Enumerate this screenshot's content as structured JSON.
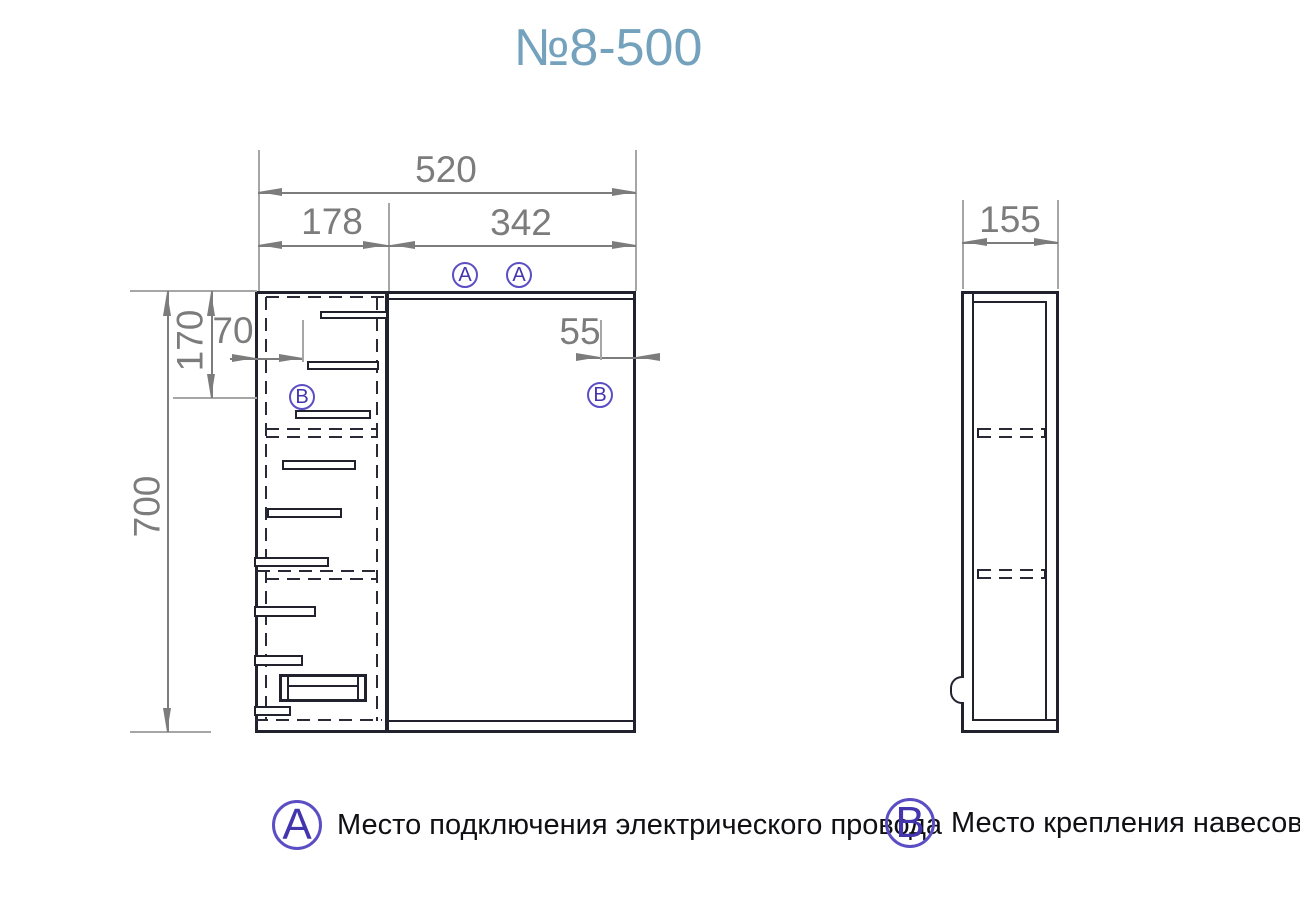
{
  "title": "№8-500",
  "markers": {
    "a": "А",
    "b": "В"
  },
  "front_view": {
    "dims": {
      "total_width": "520",
      "left_section_width": "178",
      "door_width": "342",
      "hinge_offset_left": "70",
      "hinge_offset_top": "170",
      "height": "700",
      "hinge_offset_right": "55"
    }
  },
  "side_view": {
    "depth": "155"
  },
  "legend": [
    {
      "symbol": "А",
      "text": "Место подключения электрического провода"
    },
    {
      "symbol": "В",
      "text": "Место крепления навесов"
    }
  ],
  "colors": {
    "line": "#22222e",
    "dimension": "#7c7c7c",
    "title": "#74a2bd",
    "marker": "#4335ae"
  }
}
